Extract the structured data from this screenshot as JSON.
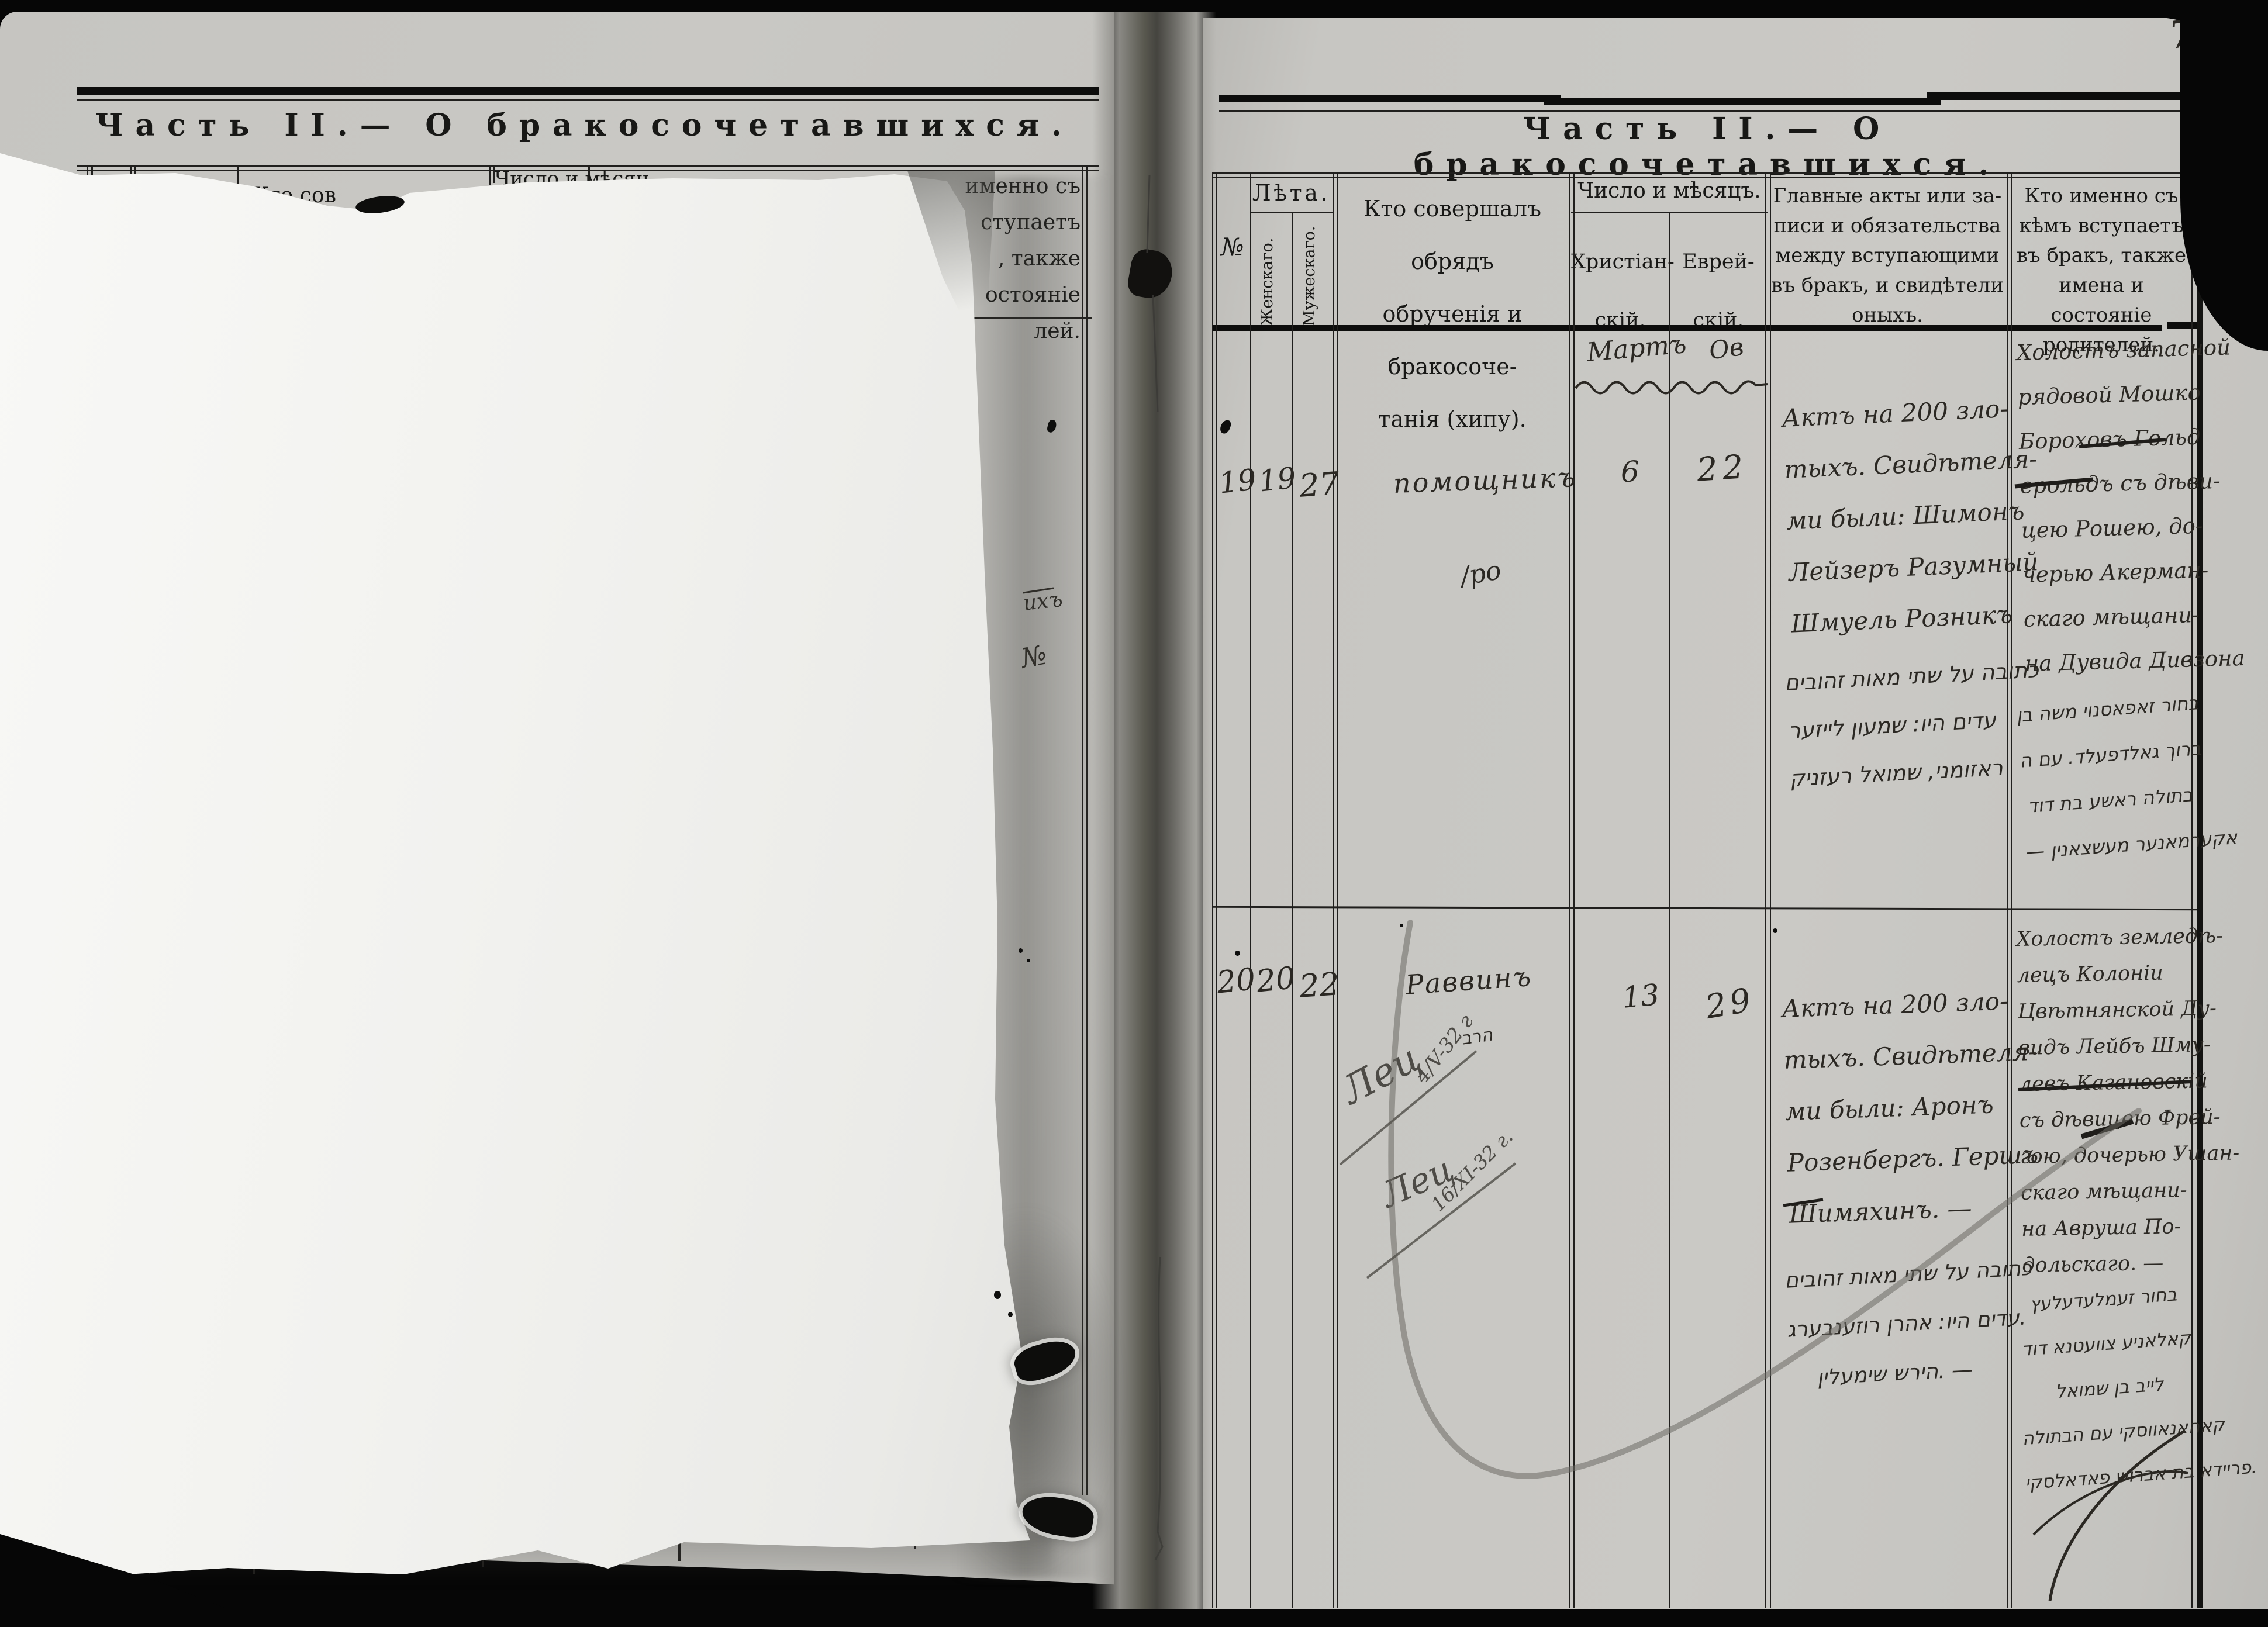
{
  "colors": {
    "page": "#c7c6c2",
    "sheet": "#f4f4f1",
    "ink": "#2b2823",
    "pencil": "#4d4b46",
    "background": "#060606"
  },
  "page_number": "7.",
  "left_page": {
    "title": "Часть II.— О бракосочетавшихся.",
    "fragments": {
      "leta": "Лѣта.",
      "kto": "Кто сов",
      "chislo": "Число и мѣсяц",
      "who_lines": [
        "именно съ",
        "ступаетъ",
        ", также",
        "остояніе",
        "лей."
      ],
      "hw_1": "ихъ",
      "hw_2": "№"
    }
  },
  "right_page": {
    "title": "Часть II.— О бракосочетавшихся.",
    "headers": {
      "no": "№",
      "leta": "Лѣта.",
      "female": "Женскаго.",
      "male": "Мужескаго.",
      "officiant_lines": [
        "Кто совершалъ обрядъ",
        "обрученія и бракосоче-",
        "танія (хипу)."
      ],
      "date_title": "Число и мѣсяцъ.",
      "christian_lines": [
        "Христіан-",
        "скій."
      ],
      "jewish_lines": [
        "Еврей-",
        "скій."
      ],
      "acts_lines": [
        "Главные акты или за-",
        "писи и обязательства",
        "между вступающими",
        "въ бракъ, и свидѣтели",
        "оныхъ."
      ],
      "who_lines": [
        "Кто именно съ",
        "кѣмъ вступаетъ",
        "въ бракъ, также",
        "имена и состояніе",
        "родителей."
      ]
    },
    "months": {
      "christian": "Мартъ",
      "jewish": "Ов"
    },
    "rows": [
      {
        "no": "19",
        "bride_age": "19",
        "groom_age": "27",
        "officiant": "помощникъ",
        "officiant_sub": "/ро",
        "day_christian": "6",
        "day_jewish": "22",
        "acts": [
          "Актъ на 200 зло-",
          "тыхъ. Свидѣтеля-",
          "ми были: Шимонъ",
          "Лейзеръ Разумный",
          "Шмуель Розникъ"
        ],
        "acts_hebrew": [
          "כתובה על שתי מאות זהובים",
          "עדים היו: שמעון לייזער",
          "ראזומני, שמואל רעזניק"
        ],
        "who": [
          "Холостъ запасной",
          "рядовой Мошко",
          "Бороховъ Гольд",
          "ерольдъ съ дѣви-",
          "цею Рошею, до-",
          "черью Акерман-",
          "скаго мѣщани-",
          "на Дувида Дивзона"
        ],
        "who_hebrew": [
          "בחור זאפאסנוי משה בן",
          "ברוך גאלדפעלד. עם ה",
          "בתולה ראשע בת דוד",
          "— אקערמאנער מעשצאנין"
        ]
      },
      {
        "no": "20",
        "bride_age": "20",
        "groom_age": "22",
        "officiant": "Раввинъ",
        "officiant_sub": "הרב",
        "day_christian": "13",
        "day_jewish": "29",
        "note1": "Лец",
        "note1_date": "4/V-32 г",
        "note2": "Лец",
        "note2_date": "16/XI-32 г.",
        "acts": [
          "Актъ на 200 зло-",
          "тыхъ. Свидѣтеля-",
          "ми были: Аронъ",
          "Розенбергъ. Гершъ",
          "Шимяхинъ. —"
        ],
        "acts_hebrew": [
          "כתובה על שתי מאות זהובים",
          "עדים היו: אהרן רוזענבערג.",
          "הירש שימעלין. —"
        ],
        "who": [
          "Холостъ земледѣ-",
          "лецъ Колоніи",
          "Цвѣтнянской Ду-",
          "видъ Лейбъ Шму-",
          "левъ Кагановскій",
          "съ дѣвицею Фрей-",
          "гою, дочерью Ушан-",
          "скаго мѣщани-",
          "на Авруша По-",
          "дольскаго. —"
        ],
        "who_hebrew": [
          "בחור זעמלעדעלעץ",
          "קאלאניע צוועטנא דוד",
          "לייב בן שמואל",
          "קאהאנאווסקי עם הבתולה",
          "פריידא בת אברוש פאדאלסקי."
        ]
      }
    ]
  }
}
